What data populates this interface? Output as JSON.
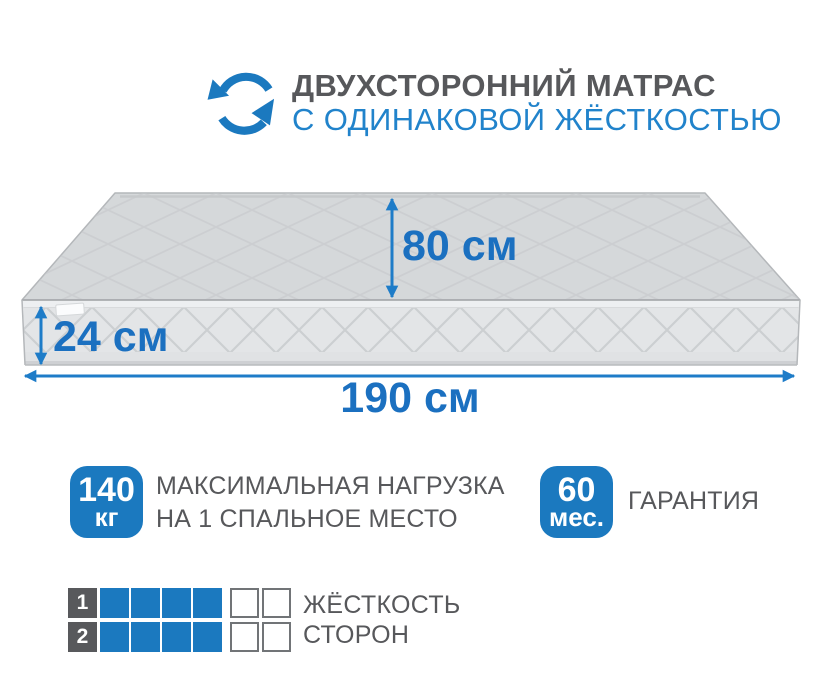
{
  "header": {
    "icon": "rotate-arrows",
    "title": "ДВУХСТОРОННИЙ МАТРАС",
    "subtitle": "С ОДИНАКОВОЙ ЖЁСТКОСТЬЮ"
  },
  "mattress": {
    "depth_label": "80 см",
    "height_label": "24 см",
    "width_label": "190 см"
  },
  "features": [
    {
      "badge_value": "140",
      "badge_unit": "кг",
      "label_line1": "МАКСИМАЛЬНАЯ НАГРУЗКА",
      "label_line2": "НА 1 СПАЛЬНОЕ МЕСТО"
    },
    {
      "badge_value": "60",
      "badge_unit": "мес.",
      "label_line1": "ГАРАНТИЯ"
    }
  ],
  "hardness": {
    "label_line1": "ЖЁСТКОСТЬ",
    "label_line2": "СТОРОН",
    "rows": [
      {
        "number": "1",
        "filled": 4,
        "total": 6
      },
      {
        "number": "2",
        "filled": 4,
        "total": 6
      }
    ]
  },
  "colors": {
    "accent_blue": "#1b79bf",
    "dimension_blue": "#1b70c0",
    "subtitle_blue": "#2183cb",
    "text_gray": "#57585b"
  }
}
